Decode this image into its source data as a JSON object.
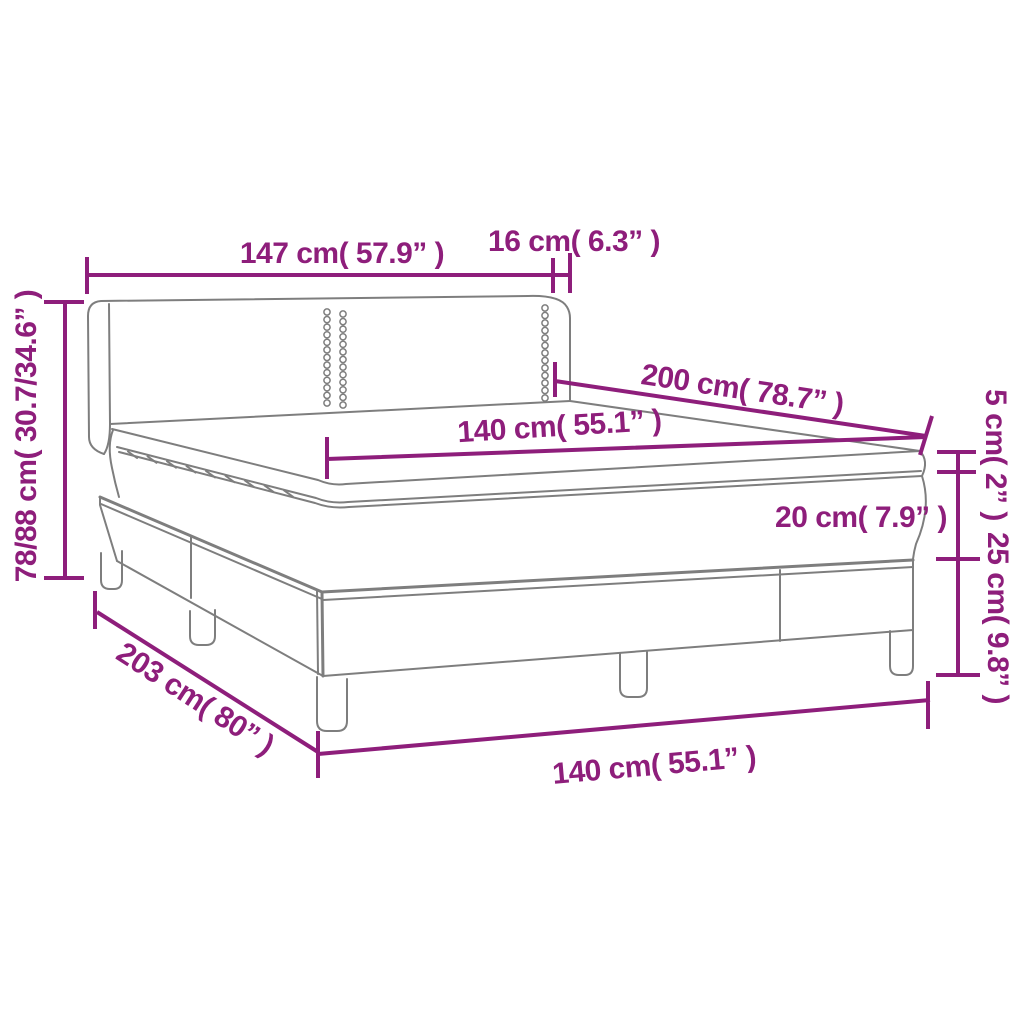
{
  "figure": {
    "title": "Box spring bed with headboard and mattress topper — dimension diagram",
    "accent_color": "#8E1E7B",
    "line_color": "#7E7E7E",
    "background_color": "#FFFFFF"
  },
  "labels": {
    "headboard_width": "147 cm( 57.9” )",
    "headboard_wing_depth": "16 cm( 6.3” )",
    "mattress_length": "200 cm( 78.7” )",
    "mattress_width_top": "140 cm( 55.1” )",
    "topper_height": "5 cm( 2” )",
    "mattress_height": "20 cm( 7.9” )",
    "base_height": "25 cm( 9.8” )",
    "overall_height": "78/88 cm( 30.7/34.6” )",
    "overall_length": "203 cm( 80” )",
    "bed_width_bottom": "140 cm( 55.1” )"
  }
}
